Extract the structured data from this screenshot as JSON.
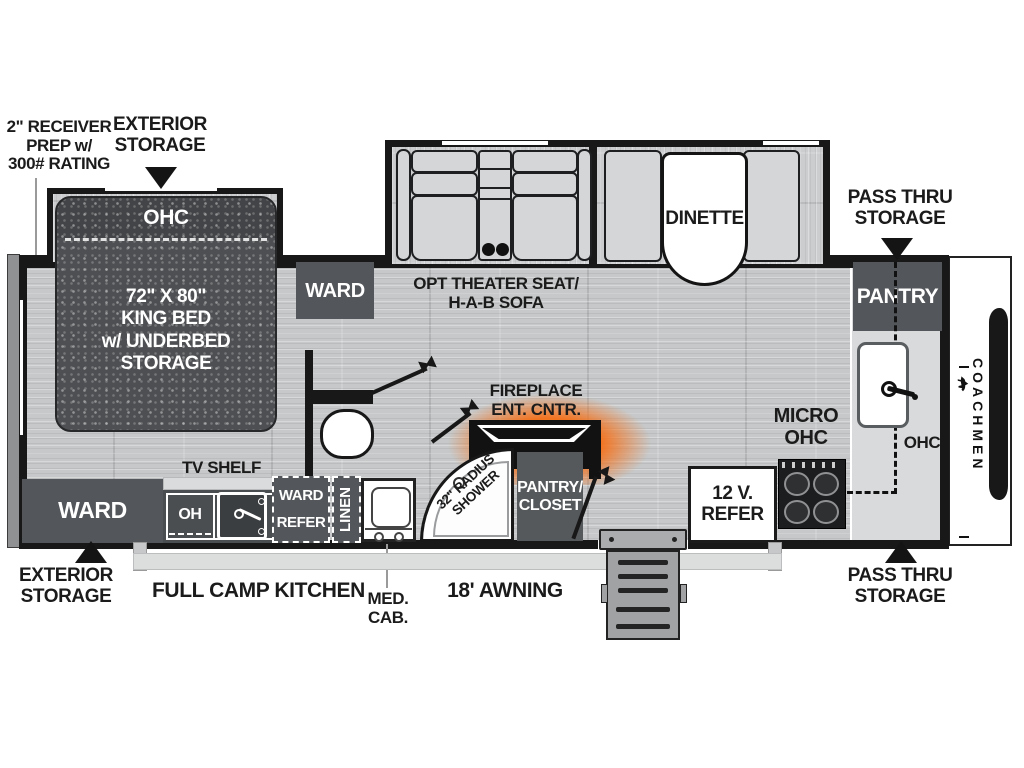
{
  "title": "Coachmen travel trailer floor plan",
  "colors": {
    "wall": "#181818",
    "floor": "#c6c8c9",
    "dark_cabinet": "#53565a",
    "bed_dark": "#4d4f52",
    "counter_light": "#d9dadb",
    "furniture": "#d4d6d7",
    "fireplace_glow": "#f3731f",
    "steps_gray": "#a0a2a3"
  },
  "callouts": {
    "receiver": [
      "2\" RECEIVER",
      "PREP w/",
      "300# RATING"
    ],
    "exterior_storage_top": [
      "EXTERIOR",
      "STORAGE"
    ],
    "pass_thru_top": [
      "PASS THRU",
      "STORAGE"
    ],
    "exterior_storage_bottom": [
      "EXTERIOR",
      "STORAGE"
    ],
    "pass_thru_bottom": [
      "PASS THRU",
      "STORAGE"
    ],
    "full_camp_kitchen": "FULL CAMP KITCHEN",
    "med_cab": [
      "MED.",
      "CAB."
    ],
    "awning": "18' AWNING"
  },
  "bedroom": {
    "ohc": "OHC",
    "bed": [
      "72\" X 80\"",
      "KING BED",
      "w/ UNDERBED",
      "STORAGE"
    ],
    "ward_top": "WARD",
    "ward_bottom": "WARD",
    "tv_shelf": "TV SHELF"
  },
  "living": {
    "sofa_caption": [
      "OPT THEATER SEAT/",
      "H-A-B SOFA"
    ],
    "dinette": "DINETTE",
    "fireplace": [
      "FIREPLACE",
      "ENT. CNTR."
    ]
  },
  "bath": {
    "shower": [
      "32\" RADIUS",
      "SHOWER"
    ],
    "pantry_closet": [
      "PANTRY/",
      "CLOSET"
    ],
    "linen": "LINEN",
    "ward_refer": [
      "WARD",
      "REFER"
    ]
  },
  "kitchen": {
    "camp_oh": "OH",
    "micro_ohc": [
      "MICRO",
      "OHC"
    ],
    "refer_12v": [
      "12 V.",
      "REFER"
    ],
    "pantry": "PANTRY",
    "ohc": "OHC"
  },
  "brand": "COACHMEN"
}
